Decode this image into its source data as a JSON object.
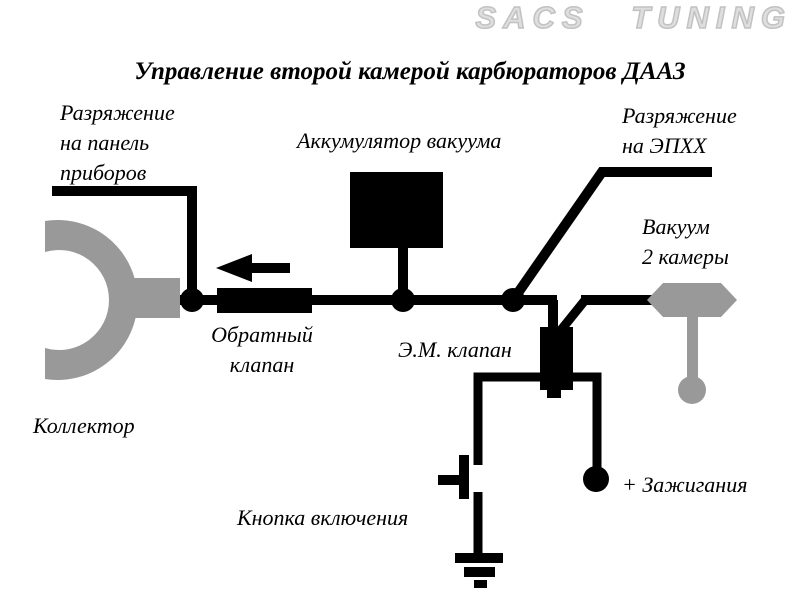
{
  "logo": {
    "text": "SACS TUNING"
  },
  "title": "Управление второй камерой карбюраторов ДААЗ",
  "labels": {
    "panel_vacuum": {
      "line1": "Разряжение",
      "line2": "на панель",
      "line3": "приборов"
    },
    "accumulator": "Аккумулятор вакуума",
    "epxx": {
      "line1": "Разряжение",
      "line2": "на ЭПХХ"
    },
    "chamber_vacuum": {
      "line1": "Вакуум",
      "line2": "2 камеры"
    },
    "check_valve": {
      "line1": "Обратный",
      "line2": "клапан"
    },
    "em_valve": "Э.М. клапан",
    "collector": "Коллектор",
    "button": "Кнопка включения",
    "ignition": "+ Зажигания"
  },
  "colors": {
    "line": "#000000",
    "component_gray": "#999999",
    "logo_gray": "#dedede",
    "background": "#ffffff"
  },
  "components": [
    "intake-manifold-collector",
    "check-valve",
    "vacuum-accumulator",
    "electromagnetic-valve",
    "second-chamber-vacuum-actuator",
    "push-button",
    "ground",
    "ignition-plus-terminal"
  ]
}
